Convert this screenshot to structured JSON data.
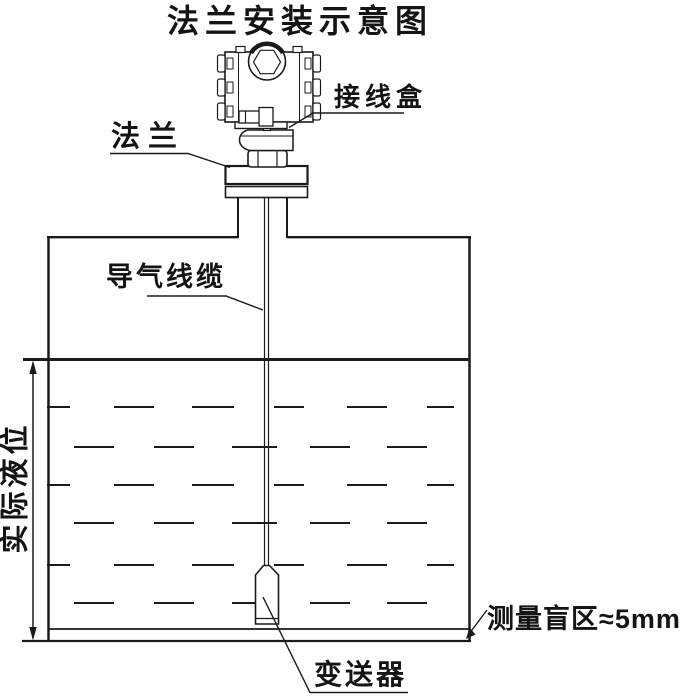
{
  "page": {
    "background": "#ffffff",
    "line_color": "#1a1a1a"
  },
  "diagram": {
    "title": "法兰安装示意图",
    "labels": {
      "junction_box": "接线盒",
      "flange": "法兰",
      "air_cable": "导气线缆",
      "actual_level": "实际液位",
      "blind_zone": "测量盲区≈5mm",
      "transmitter": "变送器"
    }
  }
}
